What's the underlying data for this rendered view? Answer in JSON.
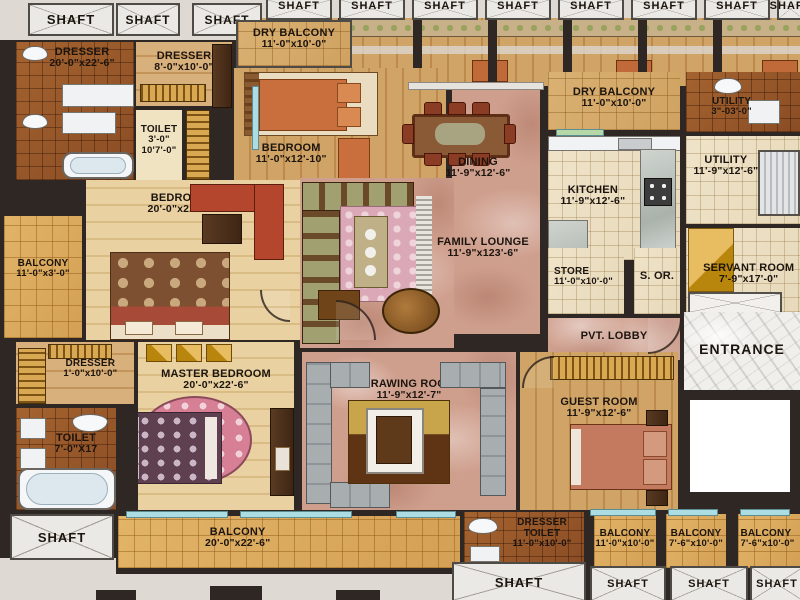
{
  "labels": {
    "shaft": "SHAFT"
  },
  "rooms": {
    "dresser_tl": {
      "name": "DRESSER",
      "dims": "20'-0\"x22'-6\""
    },
    "dresser_top": {
      "name": "DRESSER",
      "dims": "8'-0\"x10'-0\""
    },
    "toilet_tl": {
      "name": "TOILET",
      "dims": "3'-0\"",
      "dims2": "10'7'-0\""
    },
    "dry_balcony_left": {
      "name": "DRY BALCONY",
      "dims": "11'-0\"x10'-0\""
    },
    "bedroom_top": {
      "name": "BEDROOM",
      "dims": "11'-0\"x12'-10\""
    },
    "dining": {
      "name": "DINING",
      "dims": "11'-9\"x12'-6\""
    },
    "dry_balcony_right": {
      "name": "DRY BALCONY",
      "dims": "11'-0\"x10'-0\""
    },
    "utility_small": {
      "name": "UTILITY",
      "dims": "3\"-03'-0\""
    },
    "kitchen": {
      "name": "KITCHEN",
      "dims": "11'-9\"x12'-6\""
    },
    "utility_right": {
      "name": "UTILITY",
      "dims": "11'-9\"x12'-6\""
    },
    "servant_room": {
      "name": "SERVANT ROOM",
      "dims": "7'-9\"x17'-0\""
    },
    "store": {
      "name": "STORE",
      "dims": "11'-0\"x10'-0\""
    },
    "s_or": {
      "name": "S. OR."
    },
    "family_lounge": {
      "name": "FAMILY LOUNGE",
      "dims": "11'-9\"x123'-6\""
    },
    "bedroom_left": {
      "name": "BEDROOM",
      "dims": "20'-0\"x22'-6\""
    },
    "balcony_left": {
      "name": "BALCONY",
      "dims": "11'-0\"x3'-0\""
    },
    "dresser_left": {
      "name": "DRESSER",
      "dims": "1'-0\"x10'-0\""
    },
    "master_bedroom": {
      "name": "MASTER BEDROOM",
      "dims": "20'-0\"x22'-6\""
    },
    "toilet_left": {
      "name": "TOILET",
      "dims": "7'-0\"X17"
    },
    "drawing_room": {
      "name": "DRAWING ROOM",
      "dims": "11'-9\"x12'-7\""
    },
    "guest_room": {
      "name": "GUEST ROOM",
      "dims": "11'-9\"x12'-6\""
    },
    "pvt_lobby": {
      "name": "PVT. LOBBY"
    },
    "entrance": {
      "name": "ENTRANCE"
    },
    "balcony_bottom": {
      "name": "BALCONY",
      "dims": "20'-0\"x22'-6\""
    },
    "dresser_toilet": {
      "name": "DRESSER",
      "name2": "TOILET",
      "dims": "11'-0\"x10'-0\""
    },
    "balcony_b1": {
      "name": "BALCONY",
      "dims": "11'-0\"x10'-0\""
    },
    "balcony_b2": {
      "name": "BALCONY",
      "dims": "7'-6\"x10'-0\""
    },
    "balcony_b3": {
      "name": "BALCONY",
      "dims": "7'-6\"x10'-0\""
    }
  },
  "colors": {
    "wall": "#2e2723",
    "outside": "#dedad3",
    "marble_pink": "#cf9f8d",
    "marble_white": "#f1efec",
    "tile_brown": "#9a5a2e",
    "tile_gold": "#ddb065",
    "tile_cream": "#ece0c6",
    "wood": "#d2a86e",
    "window": "#abdde2",
    "bed_orange": "#c96f3d",
    "sofa_red": "#b5462e",
    "bed_salmon": "#c47a5e"
  }
}
